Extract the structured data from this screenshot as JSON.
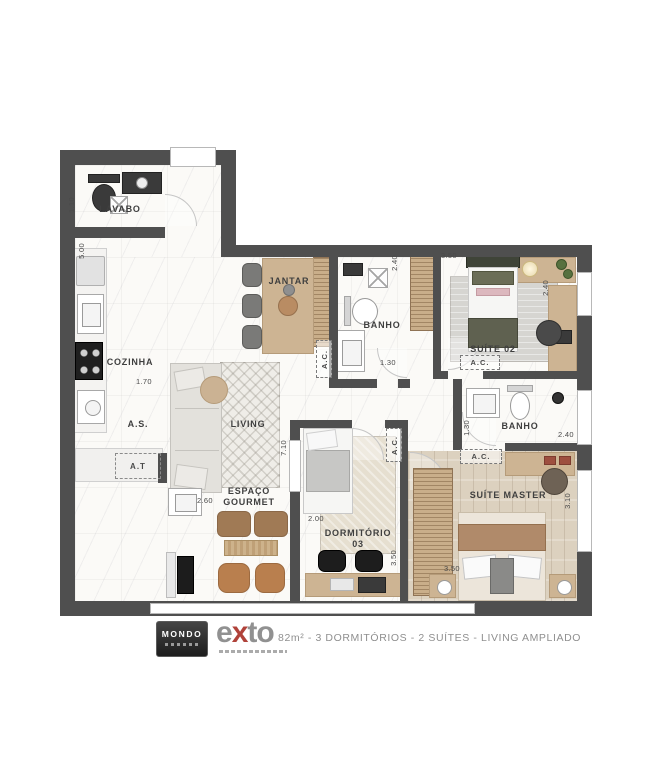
{
  "plan": {
    "rooms": {
      "lavabo": "LAVABO",
      "cozinha": "COZINHA",
      "jantar": "JANTAR",
      "banho1": "BANHO",
      "suite02": "SUÍTE 02",
      "living": "LIVING",
      "espaco_gourmet_line1": "ESPAÇO",
      "espaco_gourmet_line2": "GOURMET",
      "dormitorio03_line1": "DORMITÓRIO",
      "dormitorio03_line2": "03",
      "banho2": "BANHO",
      "suite_master": "SUÍTE MASTER",
      "area_servico": "A.S.",
      "area_tecnica": "A.T"
    },
    "ac_label": "A.C.",
    "dimensions": {
      "lavabo_w": "1.10",
      "cozinha_h": "5.00",
      "cozinha_w": "1.70",
      "gourmet_w": "2.60",
      "living_h": "7.10",
      "banho1_h": "2.40",
      "banho1_w": "1.30",
      "suite02_w": "3.50",
      "suite02_h": "2.40",
      "dorm03_w": "2.00",
      "dorm03_h": "3.50",
      "banho2_h": "1.30",
      "banho2_w": "2.40",
      "master_w": "3.50",
      "master_h": "3.10"
    }
  },
  "footer": {
    "mondo_logo": "MONDO",
    "exto_logo": {
      "e": "e",
      "x": "x",
      "to": "to"
    },
    "spec": "82m² - 3 DORMITÓRIOS - 2 SUÍTES - LIVING AMPLIADO"
  },
  "colors": {
    "wall": "#4f4f4f",
    "wood": "#cdb493",
    "accent_red": "#b0423a",
    "text_gray": "#8f8f8f"
  }
}
